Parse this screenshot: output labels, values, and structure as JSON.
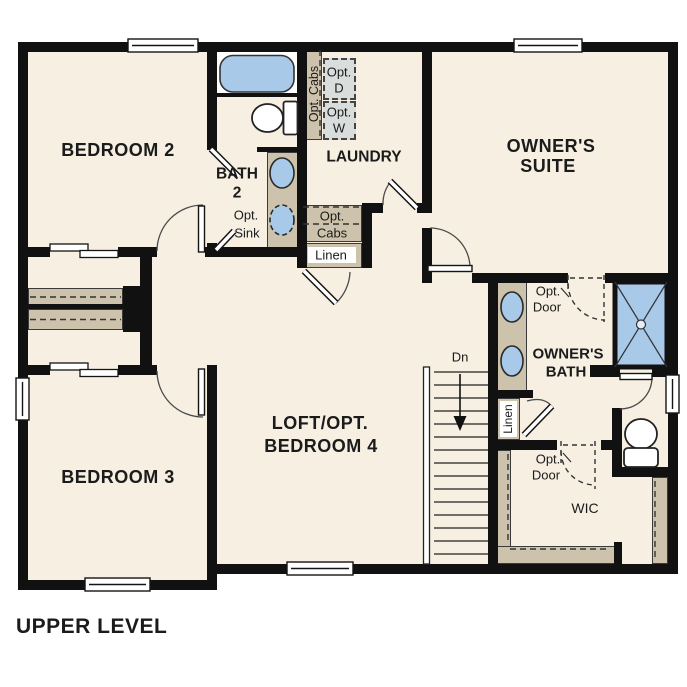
{
  "title": "UPPER LEVEL",
  "rooms": {
    "bedroom2": {
      "label": "BEDROOM 2"
    },
    "bedroom3": {
      "label": "BEDROOM 3"
    },
    "bath2": {
      "line1": "BATH",
      "line2": "2"
    },
    "laundry": {
      "label": "LAUNDRY"
    },
    "owners_suite": {
      "line1": "OWNER'S",
      "line2": "SUITE"
    },
    "loft": {
      "line1": "LOFT/OPT.",
      "line2": "BEDROOM 4"
    },
    "owners_bath": {
      "line1": "OWNER'S",
      "line2": "BATH"
    },
    "wic": {
      "label": "WIC"
    }
  },
  "annotations": {
    "opt_cabs_vertical": "Opt. Cabs",
    "opt_dryer": {
      "line1": "Opt.",
      "line2": "D"
    },
    "opt_washer": {
      "line1": "Opt.",
      "line2": "W"
    },
    "opt_sink": {
      "line1": "Opt.",
      "line2": "Sink"
    },
    "opt_cabs_box": {
      "line1": "Opt.",
      "line2": "Cabs"
    },
    "linen_hall": "Linen",
    "linen_owners": "Linen",
    "opt_door_suite": {
      "line1": "Opt.",
      "line2": "Door"
    },
    "opt_door_wic": {
      "line1": "Opt.",
      "line2": "Door"
    },
    "stairs_down": "Dn"
  },
  "icons": {
    "tub": "bathtub-icon",
    "toilet": "toilet-icon",
    "sink": "sink-icon",
    "shower": "shower-icon",
    "stairs": "staircase-icon",
    "window": "window-icon",
    "door": "door-swing-icon"
  },
  "colors": {
    "wall": "#111111",
    "floor": "#f6efe2",
    "tan": "#cdc2ab",
    "blue": "#a9c9e9",
    "gray": "#d9dddc",
    "ink": "#1b1b1b",
    "white": "#ffffff"
  }
}
